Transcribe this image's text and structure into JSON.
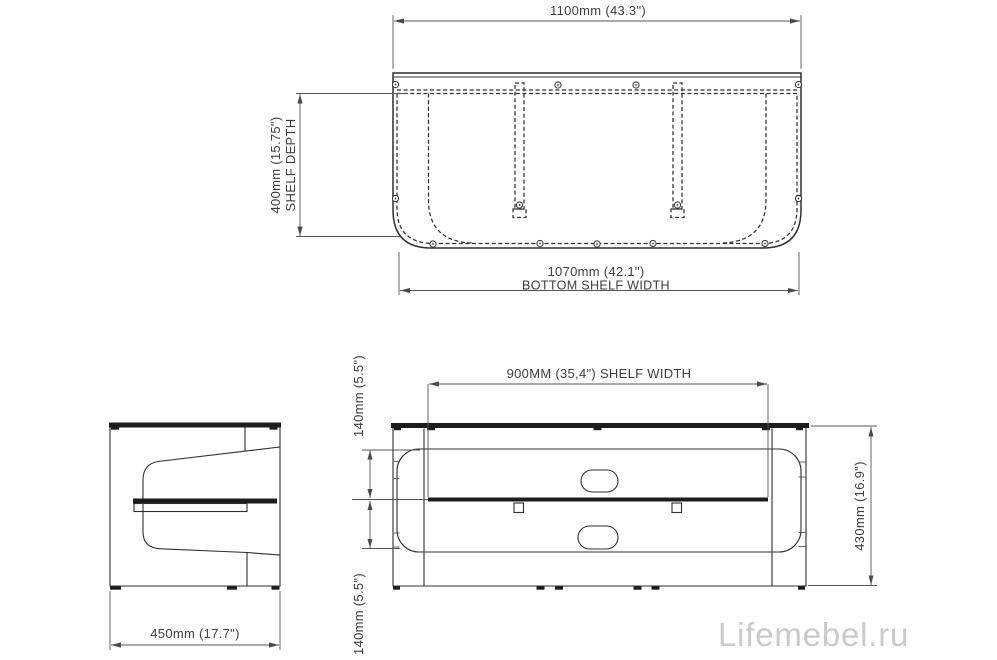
{
  "watermark": "Lifemebel.ru",
  "colors": {
    "line": "#2f2f2f",
    "dimension_line": "#555555",
    "glass": "#1c1c1c",
    "watermark": "#c9cacb",
    "background": "#ffffff"
  },
  "top_view": {
    "width_dim": "1100mm (43.3\")",
    "depth_dim_line1": "400mm (15.75\")",
    "depth_dim_line2": "SHELF DEPTH",
    "bottom_width_dim_line1": "1070mm (42.1\")",
    "bottom_width_dim_line2": "BOTTOM SHELF WIDTH"
  },
  "side_view": {
    "depth_dim": "450mm (17.7\")"
  },
  "front_view": {
    "shelf_width_dim": "900MM (35,4\") SHELF WIDTH",
    "upper_height_dim": "140mm (5.5\")",
    "lower_height_dim": "140mm (5.5\")",
    "total_height_dim": "430mm (16.9\")"
  }
}
